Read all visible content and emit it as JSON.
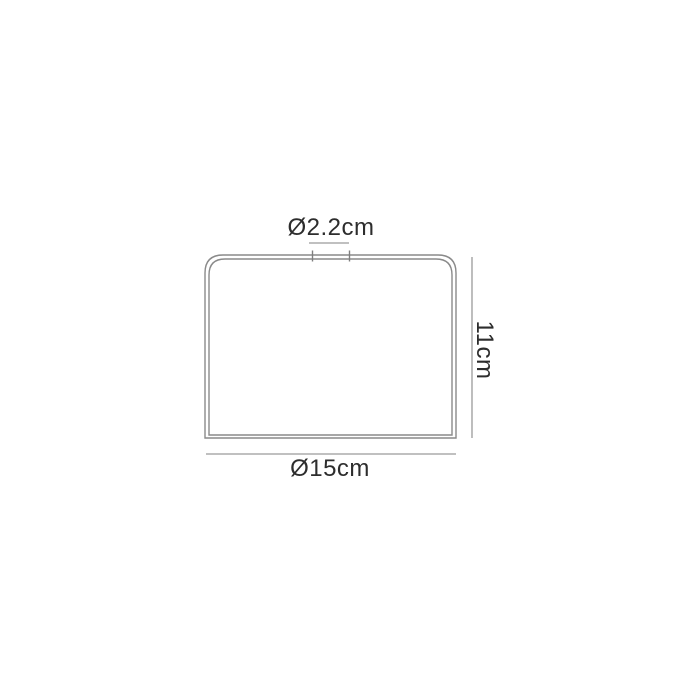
{
  "diagram": {
    "subject": "shade-side-profile-dimension-drawing",
    "dimensions": {
      "top_fitting_diameter": {
        "label": "Ø2.2cm",
        "value_cm": 2.2
      },
      "height": {
        "label": "11cm",
        "value_cm": 11
      },
      "base_diameter": {
        "label": "Ø15cm",
        "value_cm": 15
      }
    },
    "colors": {
      "background": "#ffffff",
      "outline": "#8a8a8a",
      "dimension_line": "#9a9a9a",
      "label_text": "#2d2d2d"
    }
  }
}
